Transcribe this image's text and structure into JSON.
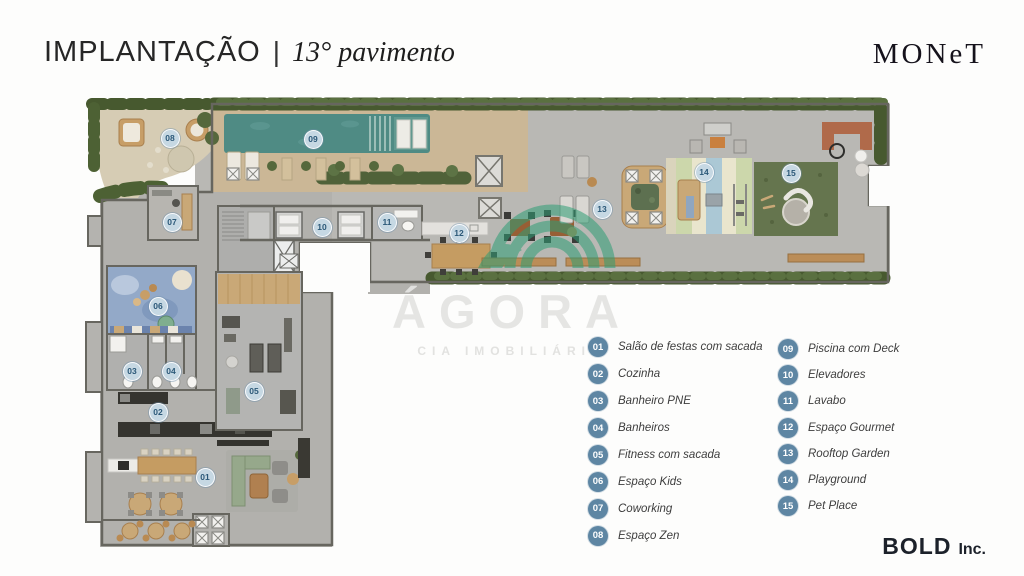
{
  "header": {
    "title_main": "IMPLANTAÇÃO",
    "title_sep": "|",
    "title_sub": "13° pavimento",
    "brand": "MONeT"
  },
  "footer": {
    "brand_bold": "BOLD",
    "brand_suffix": "Inc."
  },
  "watermark": {
    "name": "ÁGORA",
    "subtitle": "CIA IMOBILIÁRIA",
    "accent_color": "#2f9e75"
  },
  "colors": {
    "legend_badge": "#5e86a3",
    "plan_badge_fill": "#c6d8e3",
    "plan_badge_text": "#2b5878",
    "pool_water": "#4f8b84",
    "turf_green": "#65754e",
    "deck_wood": "#c9b795",
    "hedge_green": "#47592f"
  },
  "legend": {
    "columns": [
      {
        "items": [
          {
            "num": "01",
            "label": "Salão de festas com sacada"
          },
          {
            "num": "02",
            "label": "Cozinha"
          },
          {
            "num": "03",
            "label": "Banheiro PNE"
          },
          {
            "num": "04",
            "label": "Banheiros"
          },
          {
            "num": "05",
            "label": "Fitness com sacada"
          },
          {
            "num": "06",
            "label": "Espaço Kids"
          },
          {
            "num": "07",
            "label": "Coworking"
          },
          {
            "num": "08",
            "label": "Espaço Zen"
          }
        ]
      },
      {
        "items": [
          {
            "num": "09",
            "label": "Piscina com Deck"
          },
          {
            "num": "10",
            "label": "Elevadores"
          },
          {
            "num": "11",
            "label": "Lavabo"
          },
          {
            "num": "12",
            "label": "Espaço Gourmet"
          },
          {
            "num": "13",
            "label": "Rooftop Garden"
          },
          {
            "num": "14",
            "label": "Playground"
          },
          {
            "num": "15",
            "label": "Pet Place"
          }
        ]
      }
    ]
  },
  "plan": {
    "badges": [
      {
        "num": "01",
        "label": "Salão de festas com sacada",
        "x": 204,
        "y": 476
      },
      {
        "num": "02",
        "label": "Cozinha",
        "x": 157,
        "y": 411
      },
      {
        "num": "03",
        "label": "Banheiro PNE",
        "x": 131,
        "y": 370
      },
      {
        "num": "04",
        "label": "Banheiros",
        "x": 170,
        "y": 370
      },
      {
        "num": "05",
        "label": "Fitness com sacada",
        "x": 253,
        "y": 390
      },
      {
        "num": "06",
        "label": "Espaço Kids",
        "x": 157,
        "y": 305
      },
      {
        "num": "07",
        "label": "Coworking",
        "x": 171,
        "y": 221
      },
      {
        "num": "08",
        "label": "Espaço Zen",
        "x": 169,
        "y": 137
      },
      {
        "num": "09",
        "label": "Piscina com Deck",
        "x": 312,
        "y": 138
      },
      {
        "num": "10",
        "label": "Elevadores",
        "x": 321,
        "y": 226
      },
      {
        "num": "11",
        "label": "Lavabo",
        "x": 386,
        "y": 221
      },
      {
        "num": "12",
        "label": "Espaço Gourmet",
        "x": 458,
        "y": 232
      },
      {
        "num": "13",
        "label": "Rooftop Garden",
        "x": 601,
        "y": 208
      },
      {
        "num": "14",
        "label": "Playground",
        "x": 703,
        "y": 171
      },
      {
        "num": "15",
        "label": "Pet Place",
        "x": 790,
        "y": 172
      }
    ]
  }
}
